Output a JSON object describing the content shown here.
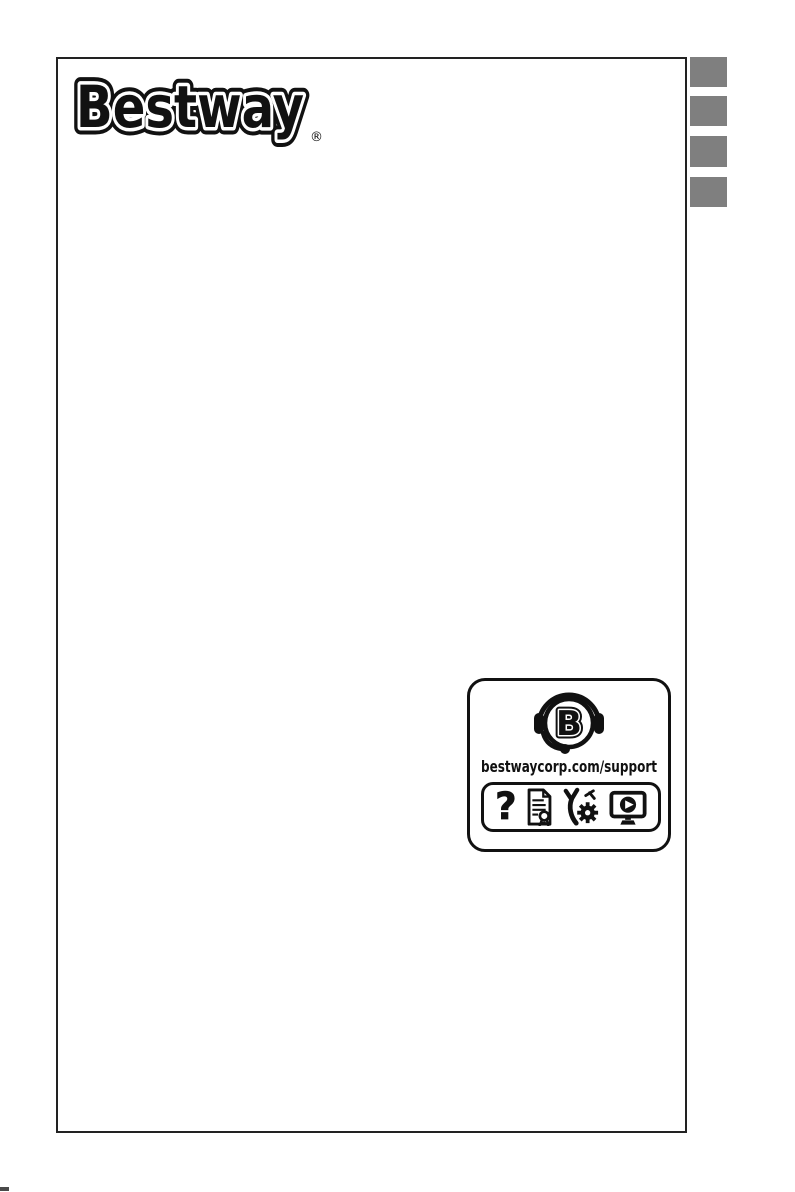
{
  "page": {
    "background_color": "#ffffff",
    "border_color": "#222222",
    "type": "manual-cover-page"
  },
  "brand_logo": {
    "text": "Bestway",
    "registered_mark": "®",
    "ink_color": "#111111"
  },
  "side_tabs": {
    "count": 4,
    "color": "#7f7f7f"
  },
  "support_badge": {
    "url": "bestwaycorp.com/support",
    "headset_letter": "B",
    "question_glyph": "?",
    "icons": [
      "headset-b-icon",
      "question-mark-icon",
      "warranty-document-icon",
      "tools-icon",
      "video-tutorial-icon"
    ]
  },
  "print_marks": {
    "bottom_left_corner_mark": true
  }
}
